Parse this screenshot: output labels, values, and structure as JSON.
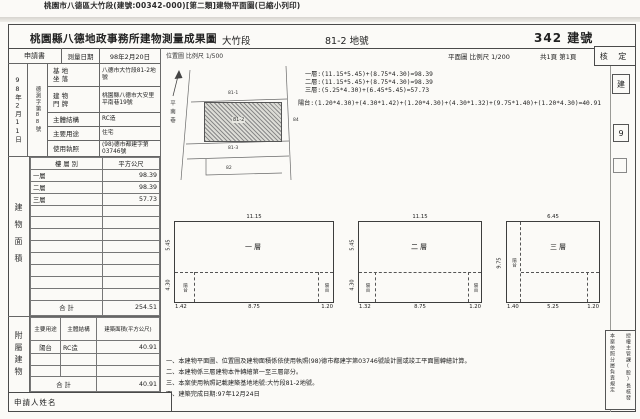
{
  "print_header": "桃園市八德區大竹段(建號:00342-000)[第二類]建物平面圖(已縮小列印)",
  "header": {
    "office_title": "桃園縣八德地政事務所建物測量成果圖",
    "section_name": "大竹段",
    "land_number": "81-2 地號",
    "building_number": "342 建號"
  },
  "receipt": {
    "date": "98年2月11日",
    "number": "德測字第88號"
  },
  "subheader": {
    "application_label": "申請書",
    "survey_date_label": "測量日期",
    "survey_date": "98年2月20日",
    "location_scale": "位置圖 比例尺 1/500",
    "plan_scale": "平面圖 比例尺 1/200",
    "page_info": "共1頁 第1頁",
    "approval_label": "核 定"
  },
  "info": {
    "site_label": "基 地\n坐 落",
    "site_value": "八德市大竹段81-2地號",
    "address_label": "建 物\n門 牌",
    "address_value": "桃園縣八德市大安里平南巷19號",
    "structure_label": "主體結構",
    "structure_value": "RC造",
    "usage_label": "主要用途",
    "usage_value": "住宅",
    "license_label": "使用執照",
    "license_value": "(98)德市都建字第03746號"
  },
  "location_map": {
    "street_name": "平南巷",
    "parcel_top": "81-1",
    "parcel_main": "81-2",
    "parcel_below": "81-3",
    "parcel_bottom": "82",
    "parcel_right": "84"
  },
  "formulas": {
    "line1": "一層:(11.15*5.45)+(8.75*4.30)=98.39",
    "line2": "二層:(11.15*5.45)+(8.75*4.30)=98.39",
    "line3": "三層:(5.25*4.30)+(6.45*5.45)=57.73",
    "line4": "陽台:(1.20*4.30)+(4.30*1.42)+(1.20*4.30)+(4.30*1.32)+(9.75*1.40)+(1.20*4.30)=40.91"
  },
  "floor_table": {
    "section_label": "建物面積",
    "header_floor": "樓 層 別",
    "header_area": "平方公尺",
    "rows": [
      [
        "一層",
        "98.39"
      ],
      [
        "二層",
        "98.39"
      ],
      [
        "三層",
        "57.73"
      ]
    ],
    "total_label": "合  計",
    "total_value": "254.51"
  },
  "accessory_table": {
    "section_label": "附屬建物",
    "header_usage": "主要用途",
    "header_structure": "主體結構",
    "header_area": "建築面積(平方公尺)",
    "rows": [
      [
        "陽台",
        "RC造",
        "40.91"
      ]
    ],
    "total_label": "合  計",
    "total_value": "40.91"
  },
  "plans": [
    {
      "name": "一層",
      "dim_top": "11.15",
      "dim_left_upper": "5.45",
      "dim_left_lower": "4.30",
      "dim_bottom_left": "1.42",
      "dim_bottom_mid": "8.75",
      "dim_bottom_right": "1.20",
      "balcony_left": "陽台",
      "balcony_right": "陽台"
    },
    {
      "name": "二層",
      "dim_top": "11.15",
      "dim_left_upper": "5.45",
      "dim_left_lower": "4.30",
      "dim_bottom_left": "1.32",
      "dim_bottom_mid": "8.75",
      "dim_bottom_right": "1.20",
      "balcony_left": "陽台",
      "balcony_right": "陽台"
    },
    {
      "name": "三層",
      "dim_top": "6.45",
      "dim_left_upper": "9.75",
      "dim_left_lower": "",
      "dim_bottom_left": "1.40",
      "dim_bottom_mid": "5.25",
      "dim_bottom_right": "1.20",
      "balcony_left": "陽台",
      "balcony_right": ""
    }
  ],
  "notes": [
    "一、本建物平面圖、位置圖及建物面積係依使用執照(98)德市都建字第03746號設計圖或竣工平面圖轉繪計算。",
    "二、本建物係三層建物本件轉繪第一至三層部分。",
    "三、本案使用執照記載建築基地地號:大竹段81-2地號。",
    "四、建築完成日期:97年12月24日"
  ],
  "applicant": {
    "label": "申請人姓名"
  },
  "right_margin": {
    "box1": "建",
    "box2": "9",
    "stamp_left": "本案依照分層負責規定",
    "stamp_right": "授權主管課(股)長核發"
  },
  "colors": {
    "paper": "#fbfaf7",
    "ink": "#222222",
    "line": "#4a4a4a"
  }
}
